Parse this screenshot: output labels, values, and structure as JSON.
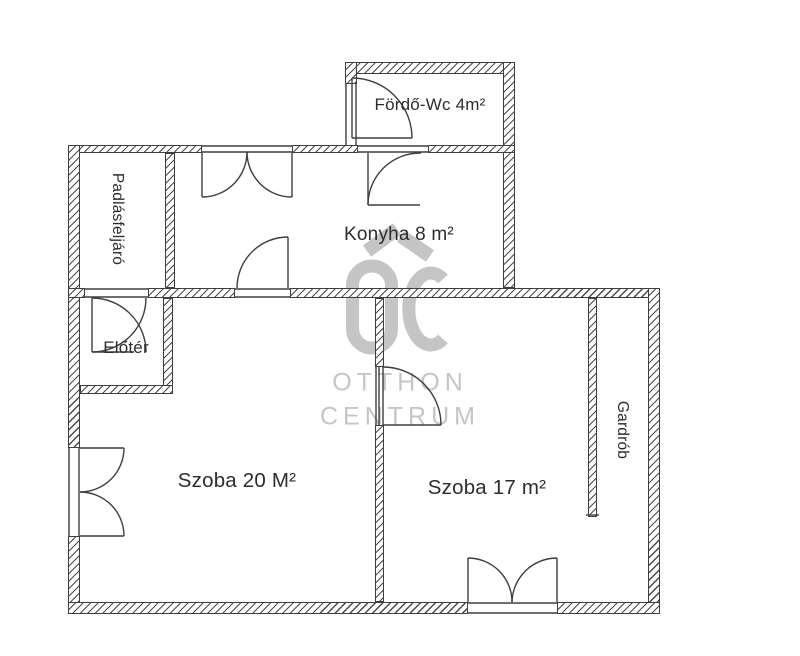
{
  "plan": {
    "rooms": [
      {
        "id": "bathroom",
        "label": "Fördő-Wc 4m²"
      },
      {
        "id": "attic-access",
        "label": "Padlásfeljáró"
      },
      {
        "id": "kitchen",
        "label": "Konyha 8 m²"
      },
      {
        "id": "hall",
        "label": "Előtér"
      },
      {
        "id": "room-20",
        "label": "Szoba 20 M²"
      },
      {
        "id": "room-17",
        "label": "Szoba 17 m²"
      },
      {
        "id": "wardrobe",
        "label": "Gardrób"
      }
    ]
  },
  "watermark": {
    "logo_letters": "OC",
    "line1": "OTTHON",
    "line2": "CENTRUM"
  },
  "colors": {
    "wall_line": "#3e3e3e",
    "label_text": "#2d2d2d",
    "watermark_gray": "#c5c5c5",
    "background": "#ffffff"
  }
}
